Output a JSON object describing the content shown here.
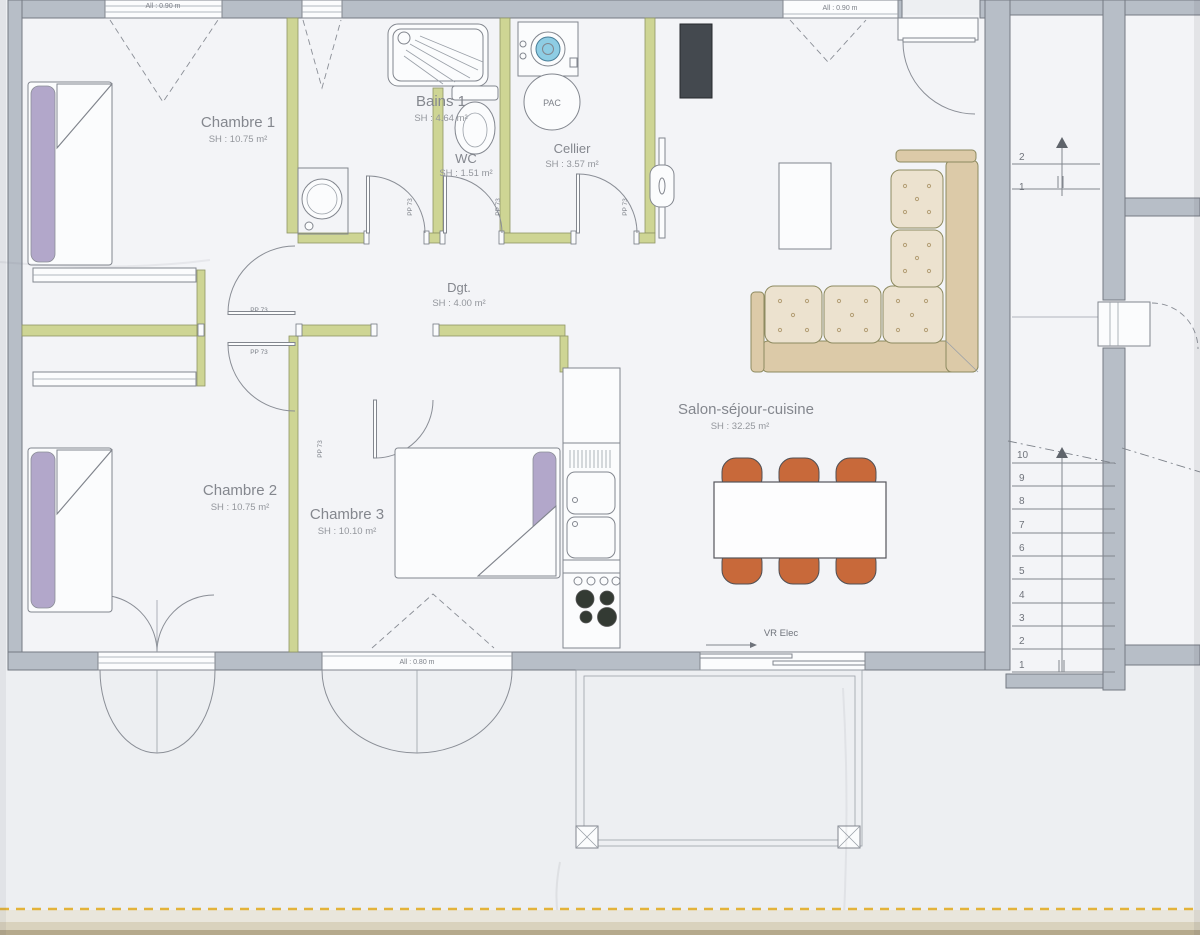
{
  "plan": {
    "rooms": [
      {
        "name": "Chambre 1",
        "area": "SH : 10.75 m²"
      },
      {
        "name": "Bains 1",
        "area": "SH : 4.64 m²"
      },
      {
        "name": "WC",
        "area": "SH : 1.51 m²"
      },
      {
        "name": "Cellier",
        "area": "SH : 3.57 m²"
      },
      {
        "name": "Dgt.",
        "area": "SH : 4.00 m²"
      },
      {
        "name": "Chambre 2",
        "area": "SH : 10.75 m²"
      },
      {
        "name": "Chambre 3",
        "area": "SH : 10.10 m²"
      },
      {
        "name": "Salon-séjour-cuisine",
        "area": "SH : 32.25 m²"
      }
    ],
    "equipment": {
      "heat_pump": "PAC"
    },
    "annotations": {
      "door_ref": "PP 73",
      "window_sill_90": "All : 0.90 m",
      "window_sill_80": "All : 0.80 m",
      "shutter_elec": "VR Elec"
    },
    "stairs": {
      "upper_steps": [
        "2",
        "1"
      ],
      "lower_steps": [
        "10",
        "9",
        "8",
        "7",
        "6",
        "5",
        "4",
        "3",
        "2",
        "1"
      ]
    },
    "colors": {
      "exterior_wall": "#b7bec7",
      "interior_wall": "#ced594",
      "chair": "#c8693a",
      "sofa": "#ece2cf",
      "pillow": "#b2a7ca",
      "washer_door": "#8ecde4",
      "scan_line": "#e3b33a"
    }
  }
}
